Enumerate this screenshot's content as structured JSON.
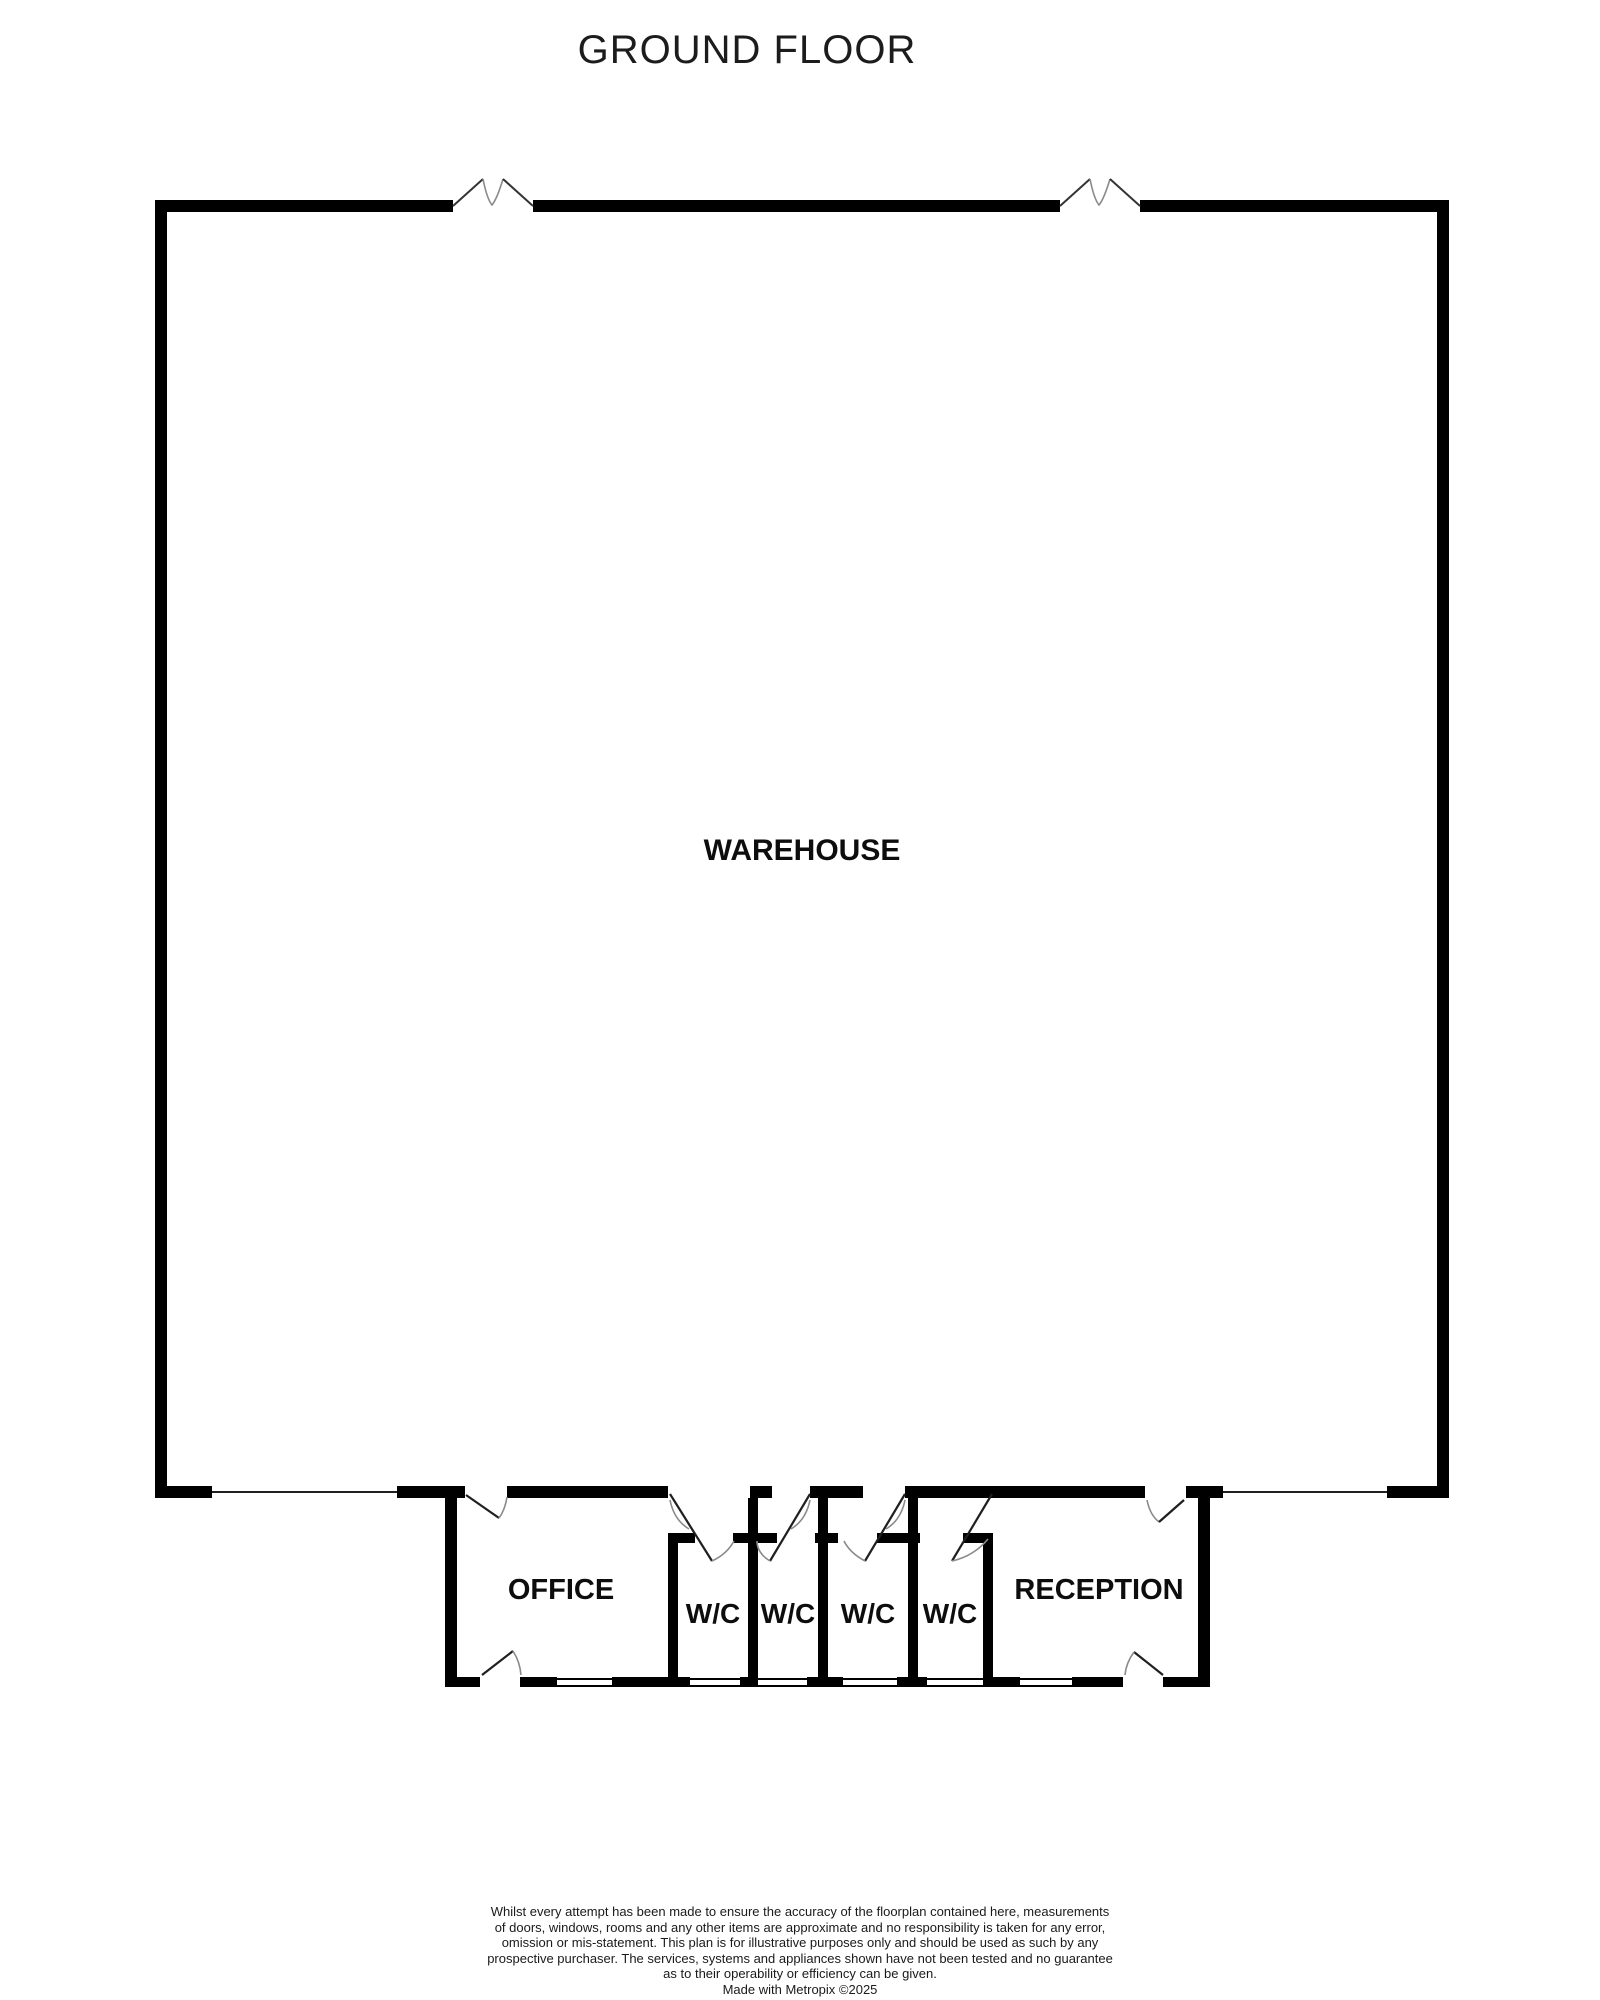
{
  "title": "GROUND FLOOR",
  "rooms": {
    "warehouse": "WAREHOUSE",
    "office": "OFFICE",
    "wc": [
      "W/C",
      "W/C",
      "W/C",
      "W/C"
    ],
    "reception": "RECEPTION"
  },
  "symbols": {
    "doors": 8,
    "windows": 6,
    "wall_breaks": 2
  },
  "colors": {
    "wall": "#000000",
    "door_line": "#1f1f1f",
    "break_accent": "#8a8a8a",
    "text": "#0d0d0d",
    "background": "#ffffff"
  },
  "footer": {
    "lines": [
      "Whilst every attempt has been made to ensure the accuracy of the floorplan contained here, measurements",
      "of doors, windows, rooms and any other items are approximate and no responsibility is taken for any error,",
      "omission or mis-statement. This plan is for illustrative purposes only and should be used as such by any",
      "prospective purchaser. The services, systems and appliances shown have not been tested and no guarantee",
      "as to their operability or efficiency can be given.",
      "Made with Metropix ©2025"
    ]
  }
}
